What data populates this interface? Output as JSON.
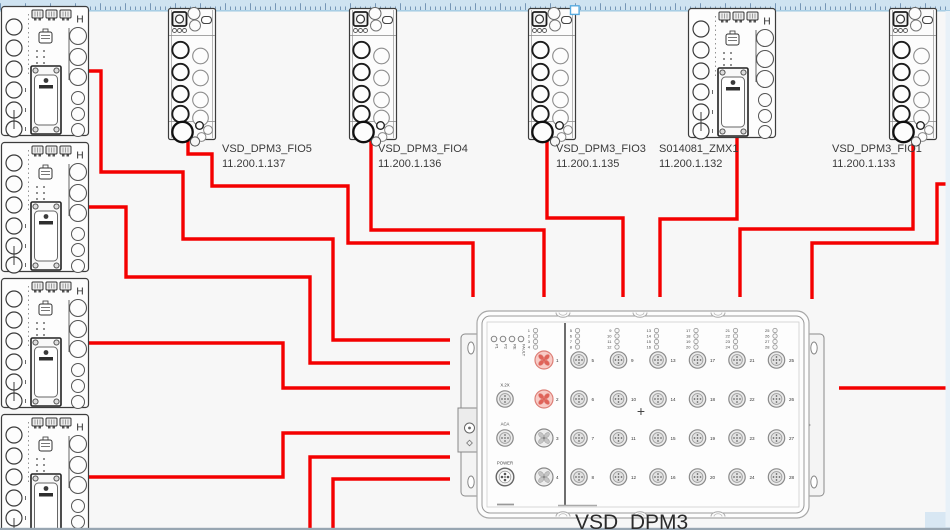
{
  "editor": {
    "ruler": {
      "band_color": "#cfe3f1",
      "tick_color": "#5f82a8",
      "line_color": "#9fc8e2",
      "handle_border": "#58abdf"
    },
    "scroll": {
      "bottom_bar_color": "#98a6b2",
      "corner_color": "#d8e7f3",
      "right_strip_color": "#e8f1f8"
    }
  },
  "diagram": {
    "accent_red": "#f40000",
    "highlight_port_fill": "#f8cbc6",
    "highlight_port_stroke": "#dd7f77",
    "highlight_blade": "#e06258",
    "zmx_h_label": "H"
  },
  "nodes": {
    "left_modules": [
      {
        "id": "left-zmx-1",
        "x": 1,
        "y": 6
      },
      {
        "id": "left-zmx-2",
        "x": 1,
        "y": 142
      },
      {
        "id": "left-zmx-3",
        "x": 1,
        "y": 278
      },
      {
        "id": "left-zmx-4",
        "x": 1,
        "y": 414
      }
    ],
    "top_modules": [
      {
        "id": "fio5",
        "type": "fio",
        "x": 168,
        "y": 8,
        "name": "VSD_DPM3_FIO5",
        "ip": "11.200.1.137",
        "label": {
          "x": 222,
          "y": 142
        }
      },
      {
        "id": "fio4",
        "type": "fio",
        "x": 349,
        "y": 8,
        "name": "VSD_DPM3_FIO4",
        "ip": "11.200.1.136",
        "label": {
          "x": 378,
          "y": 142
        }
      },
      {
        "id": "fio3",
        "type": "fio",
        "x": 528,
        "y": 8,
        "name": "VSD_DPM3_FIO3",
        "ip": "11.200.1.135",
        "label": {
          "x": 556,
          "y": 142
        }
      },
      {
        "id": "zmx1",
        "type": "zmx",
        "x": 688,
        "y": 8,
        "name": "S014081_ZMX1",
        "ip": "11.200.1.132",
        "label": {
          "x": 659,
          "y": 142
        }
      },
      {
        "id": "fio1",
        "type": "fio",
        "x": 889,
        "y": 8,
        "name": "VSD_DPM3_FIO1",
        "ip": "11.200.1.133",
        "label": {
          "x": 832,
          "y": 142
        }
      }
    ],
    "hub": {
      "id": "hub",
      "name": "VSD_DPM3",
      "label": {
        "x": 575,
        "y": 511
      },
      "status_leds": [
        "P1",
        "P2",
        "RE",
        "FAULT"
      ],
      "connectors": [
        "X.2X",
        "ACA",
        "POWER"
      ],
      "center_mark": "+",
      "ports_left": [
        {
          "n": "1",
          "highlight": true
        },
        {
          "n": "2",
          "highlight": true
        },
        {
          "n": "3",
          "highlight": false
        },
        {
          "n": "4",
          "highlight": false
        }
      ],
      "port_grid_numbers": [
        [
          "5",
          "6",
          "7",
          "8"
        ],
        [
          "9",
          "10",
          "11",
          "12"
        ],
        [
          "13",
          "14",
          "15",
          "16"
        ],
        [
          "17",
          "18",
          "19",
          "20"
        ],
        [
          "21",
          "22",
          "23",
          "24"
        ],
        [
          "25",
          "26",
          "27",
          "28"
        ]
      ],
      "led_groups": [
        [
          "1",
          "2",
          "3",
          "4"
        ],
        [
          "5",
          "6",
          "7",
          "8"
        ],
        [
          "9",
          "10",
          "11",
          "12"
        ],
        [
          "13",
          "14",
          "15",
          "16"
        ],
        [
          "17",
          "18",
          "19",
          "20"
        ],
        [
          "21",
          "22",
          "23",
          "24"
        ],
        [
          "25",
          "26",
          "27",
          "28"
        ]
      ]
    }
  },
  "connections": [
    {
      "from": "left-zmx-1",
      "to": "hub",
      "points": [
        [
          88,
          71
        ],
        [
          101,
          71
        ],
        [
          101,
          172
        ],
        [
          183,
          172
        ],
        [
          183,
          239
        ],
        [
          333,
          239
        ],
        [
          333,
          340
        ],
        [
          450,
          340
        ]
      ]
    },
    {
      "from": "left-zmx-2",
      "to": "hub",
      "points": [
        [
          88,
          207
        ],
        [
          126,
          207
        ],
        [
          126,
          277
        ],
        [
          310,
          277
        ],
        [
          310,
          363
        ],
        [
          450,
          363
        ]
      ]
    },
    {
      "from": "left-zmx-3",
      "to": "hub",
      "points": [
        [
          88,
          343
        ],
        [
          283,
          343
        ],
        [
          283,
          388
        ],
        [
          450,
          388
        ]
      ]
    },
    {
      "from": "left-zmx-4",
      "to": "hub",
      "points": [
        [
          88,
          477
        ],
        [
          283,
          477
        ],
        [
          283,
          433
        ],
        [
          450,
          433
        ]
      ]
    },
    {
      "from": "offscreen-bottom-1",
      "to": "hub",
      "points": [
        [
          310,
          531
        ],
        [
          310,
          457
        ],
        [
          450,
          457
        ]
      ]
    },
    {
      "from": "offscreen-bottom-2",
      "to": "hub",
      "points": [
        [
          333,
          531
        ],
        [
          333,
          479
        ],
        [
          450,
          479
        ]
      ]
    },
    {
      "from": "fio5",
      "to": "hub",
      "points": [
        [
          188,
          141
        ],
        [
          188,
          154
        ],
        [
          212,
          154
        ],
        [
          212,
          186
        ],
        [
          348,
          186
        ],
        [
          348,
          243
        ],
        [
          473,
          243
        ],
        [
          473,
          297
        ]
      ]
    },
    {
      "from": "fio4",
      "to": "hub",
      "points": [
        [
          371,
          141
        ],
        [
          371,
          230
        ],
        [
          544,
          230
        ],
        [
          544,
          297
        ]
      ]
    },
    {
      "from": "fio3",
      "to": "hub",
      "points": [
        [
          547,
          141
        ],
        [
          547,
          218
        ],
        [
          623,
          218
        ],
        [
          623,
          297
        ]
      ]
    },
    {
      "from": "zmx1",
      "to": "hub",
      "points": [
        [
          737,
          138
        ],
        [
          737,
          219
        ],
        [
          660,
          219
        ],
        [
          660,
          297
        ]
      ]
    },
    {
      "from": "fio1",
      "to": "hub",
      "points": [
        [
          913,
          141
        ],
        [
          913,
          229
        ],
        [
          740,
          229
        ],
        [
          740,
          297
        ]
      ]
    },
    {
      "from": "offscreen-right-1",
      "to": "hub",
      "points": [
        [
          951,
          184
        ],
        [
          937,
          184
        ],
        [
          937,
          243
        ],
        [
          812,
          243
        ],
        [
          812,
          299
        ]
      ]
    },
    {
      "from": "offscreen-right-2",
      "to": "hub",
      "points": [
        [
          951,
          388
        ],
        [
          839,
          388
        ]
      ]
    }
  ]
}
